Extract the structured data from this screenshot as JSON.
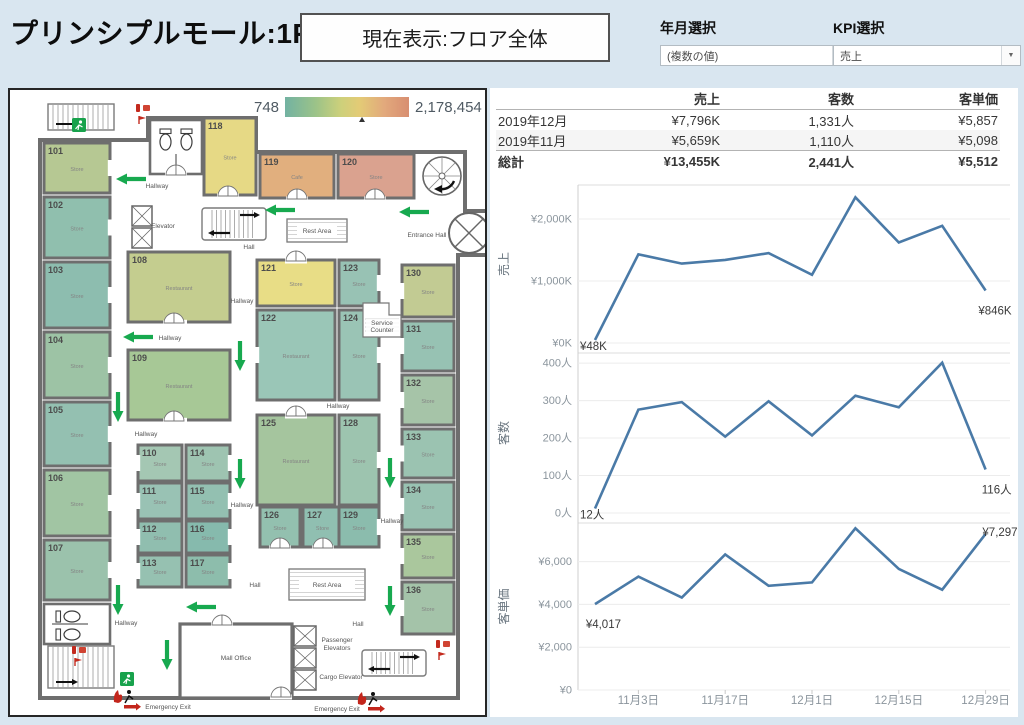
{
  "header": {
    "title": "プリンシプルモール:1F",
    "current_view": "現在表示:フロア全体",
    "filters": [
      {
        "label": "年月選択",
        "value": "(複数の値)"
      },
      {
        "label": "KPI選択",
        "value": "売上"
      }
    ],
    "caret_glyph": "▼"
  },
  "legend": {
    "min": "748",
    "max": "2,178,454",
    "marker_fraction": 0.6
  },
  "table": {
    "headers": [
      "",
      "売上",
      "客数",
      "客単価"
    ],
    "rows": [
      {
        "label": "2019年12月",
        "cells": [
          "¥7,796K",
          "1,331人",
          "¥5,857"
        ],
        "style": "normal"
      },
      {
        "label": "2019年11月",
        "cells": [
          "¥5,659K",
          "1,110人",
          "¥5,098"
        ],
        "style": "shaded"
      },
      {
        "label": "総計",
        "cells": [
          "¥13,455K",
          "2,441人",
          "¥5,512"
        ],
        "style": "total"
      }
    ]
  },
  "chart_data": {
    "type": "line",
    "line_color": "#4a7aa7",
    "x_axis": {
      "tick_labels": [
        "11月3日",
        "11月17日",
        "12月1日",
        "12月15日",
        "12月29日"
      ],
      "tick_point_indexes": [
        1,
        3,
        5,
        7,
        9
      ],
      "n_points": 10
    },
    "charts": [
      {
        "ylabel": "売上",
        "ymax": 2548,
        "unit": "K",
        "yticks": [
          {
            "v": 0,
            "label": "¥0K"
          },
          {
            "v": 1000,
            "label": "¥1,000K"
          },
          {
            "v": 2000,
            "label": "¥2,000K"
          }
        ],
        "values": [
          48,
          1430,
          1280,
          1340,
          1450,
          1100,
          2350,
          1620,
          1890,
          846
        ],
        "annotations": [
          {
            "text": "¥48K",
            "index": 0,
            "pos": "right"
          },
          {
            "text": "¥846K",
            "index": 9,
            "pos": "below"
          }
        ]
      },
      {
        "ylabel": "客数",
        "ymax": 427,
        "unit": "人",
        "yticks": [
          {
            "v": 0,
            "label": "0人"
          },
          {
            "v": 100,
            "label": "100人"
          },
          {
            "v": 200,
            "label": "200人"
          },
          {
            "v": 300,
            "label": "300人"
          },
          {
            "v": 400,
            "label": "400人"
          }
        ],
        "values": [
          12,
          276,
          296,
          204,
          298,
          207,
          313,
          282,
          401,
          116
        ],
        "annotations": [
          {
            "text": "12人",
            "index": 0,
            "pos": "right"
          },
          {
            "text": "116人",
            "index": 9,
            "pos": "below"
          }
        ]
      },
      {
        "ylabel": "客単価",
        "ymax": 7806,
        "unit": "円",
        "yticks": [
          {
            "v": 0,
            "label": "¥0"
          },
          {
            "v": 2000,
            "label": "¥2,000"
          },
          {
            "v": 4000,
            "label": "¥4,000"
          },
          {
            "v": 6000,
            "label": "¥6,000"
          }
        ],
        "values": [
          4017,
          5300,
          4320,
          6340,
          4870,
          5030,
          7560,
          5660,
          4690,
          7297
        ],
        "annotations": [
          {
            "text": "¥4,017",
            "index": 0,
            "pos": "below"
          },
          {
            "text": "¥7,297",
            "index": 9,
            "pos": "above"
          }
        ]
      }
    ]
  },
  "map": {
    "rooms": [
      {
        "id": "101",
        "label": "Store",
        "x": 34,
        "y": 53,
        "w": 66,
        "h": 50,
        "color": "#b6c893",
        "door": "right"
      },
      {
        "id": "102",
        "label": "Store",
        "x": 34,
        "y": 107,
        "w": 66,
        "h": 61,
        "color": "#90bfae",
        "door": "right"
      },
      {
        "id": "103",
        "label": "Store",
        "x": 34,
        "y": 172,
        "w": 66,
        "h": 66,
        "color": "#8dbdaf",
        "door": "right"
      },
      {
        "id": "104",
        "label": "Store",
        "x": 34,
        "y": 242,
        "w": 66,
        "h": 66,
        "color": "#9dc3a5",
        "door": "right"
      },
      {
        "id": "105",
        "label": "Store",
        "x": 34,
        "y": 312,
        "w": 66,
        "h": 64,
        "color": "#94c0b1",
        "door": "right"
      },
      {
        "id": "106",
        "label": "Store",
        "x": 34,
        "y": 380,
        "w": 66,
        "h": 66,
        "color": "#a1c5a3",
        "door": "right"
      },
      {
        "id": "107",
        "label": "Store",
        "x": 34,
        "y": 450,
        "w": 66,
        "h": 60,
        "color": "#9bc2ac",
        "door": "right"
      },
      {
        "id": "118",
        "label": "Store",
        "x": 194,
        "y": 28,
        "w": 52,
        "h": 77,
        "color": "#e6d985",
        "door": "bottom"
      },
      {
        "id": "119",
        "label": "Cafe",
        "x": 250,
        "y": 64,
        "w": 74,
        "h": 44,
        "color": "#e1af7e",
        "door": "bottom"
      },
      {
        "id": "120",
        "label": "Store",
        "x": 328,
        "y": 64,
        "w": 76,
        "h": 44,
        "color": "#daa28f",
        "door": "bottom"
      },
      {
        "id": "108",
        "label": "Restaurant",
        "x": 118,
        "y": 162,
        "w": 102,
        "h": 70,
        "color": "#c4cd8f",
        "door": "bottom"
      },
      {
        "id": "109",
        "label": "Restaurant",
        "x": 118,
        "y": 260,
        "w": 102,
        "h": 70,
        "color": "#a7c896",
        "door": "bottom"
      },
      {
        "id": "110",
        "label": "Store",
        "x": 128,
        "y": 355,
        "w": 44,
        "h": 36,
        "color": "#a4c7b3",
        "door": "left"
      },
      {
        "id": "114",
        "label": "Store",
        "x": 176,
        "y": 355,
        "w": 44,
        "h": 36,
        "color": "#9ec4b1",
        "door": "right"
      },
      {
        "id": "111",
        "label": "Store",
        "x": 128,
        "y": 393,
        "w": 44,
        "h": 36,
        "color": "#99c2b4",
        "door": "left"
      },
      {
        "id": "115",
        "label": "Store",
        "x": 176,
        "y": 393,
        "w": 44,
        "h": 36,
        "color": "#93c0b1",
        "door": "right"
      },
      {
        "id": "112",
        "label": "Store",
        "x": 128,
        "y": 431,
        "w": 44,
        "h": 32,
        "color": "#90beaf",
        "door": "left"
      },
      {
        "id": "116",
        "label": "Store",
        "x": 176,
        "y": 431,
        "w": 44,
        "h": 32,
        "color": "#86baad",
        "door": "right"
      },
      {
        "id": "113",
        "label": "Store",
        "x": 128,
        "y": 465,
        "w": 44,
        "h": 32,
        "color": "#96c1b1",
        "door": "left"
      },
      {
        "id": "117",
        "label": "Store",
        "x": 176,
        "y": 465,
        "w": 44,
        "h": 32,
        "color": "#8dbdac",
        "door": "right"
      },
      {
        "id": "121",
        "label": "Store",
        "x": 247,
        "y": 170,
        "w": 78,
        "h": 46,
        "color": "#e8dd86",
        "door": "top"
      },
      {
        "id": "123",
        "label": "Store",
        "x": 329,
        "y": 170,
        "w": 40,
        "h": 46,
        "color": "#98c2b4",
        "door": "right"
      },
      {
        "id": "122",
        "label": "Restaurant",
        "x": 247,
        "y": 220,
        "w": 78,
        "h": 90,
        "color": "#9ac6b7",
        "door": "left"
      },
      {
        "id": "124",
        "label": "Store",
        "x": 329,
        "y": 220,
        "w": 40,
        "h": 90,
        "color": "#9ac4b5",
        "door": "right"
      },
      {
        "id": "125",
        "label": "Restaurant",
        "x": 247,
        "y": 325,
        "w": 78,
        "h": 90,
        "color": "#a5c59e",
        "door": "top"
      },
      {
        "id": "128",
        "label": "Store",
        "x": 329,
        "y": 325,
        "w": 40,
        "h": 90,
        "color": "#9dc4af",
        "door": "right"
      },
      {
        "id": "126",
        "label": "Store",
        "x": 250,
        "y": 417,
        "w": 40,
        "h": 40,
        "color": "#93c0af",
        "door": "bottom"
      },
      {
        "id": "127",
        "label": "Store",
        "x": 293,
        "y": 417,
        "w": 39,
        "h": 40,
        "color": "#90bfb1",
        "door": "bottom"
      },
      {
        "id": "129",
        "label": "Store",
        "x": 329,
        "y": 417,
        "w": 40,
        "h": 40,
        "color": "#8bbcad",
        "door": "right"
      },
      {
        "id": "130",
        "label": "Store",
        "x": 392,
        "y": 175,
        "w": 52,
        "h": 52,
        "color": "#c2cb93",
        "door": "left"
      },
      {
        "id": "131",
        "label": "Store",
        "x": 392,
        "y": 231,
        "w": 52,
        "h": 50,
        "color": "#97c2b3",
        "door": "left"
      },
      {
        "id": "132",
        "label": "Store",
        "x": 392,
        "y": 285,
        "w": 52,
        "h": 50,
        "color": "#a6c4a8",
        "door": "left"
      },
      {
        "id": "133",
        "label": "Store",
        "x": 392,
        "y": 339,
        "w": 52,
        "h": 49,
        "color": "#9bc3b1",
        "door": "left"
      },
      {
        "id": "134",
        "label": "Store",
        "x": 392,
        "y": 392,
        "w": 52,
        "h": 48,
        "color": "#99c2b2",
        "door": "left"
      },
      {
        "id": "135",
        "label": "Store",
        "x": 392,
        "y": 444,
        "w": 52,
        "h": 44,
        "color": "#aac79d",
        "door": "left"
      },
      {
        "id": "136",
        "label": "Store",
        "x": 392,
        "y": 492,
        "w": 52,
        "h": 52,
        "color": "#a4c3a9",
        "door": "left"
      }
    ],
    "labels": [
      {
        "text": "Hallway",
        "x": 147,
        "y": 98
      },
      {
        "text": "Hallway",
        "x": 232,
        "y": 213
      },
      {
        "text": "Hallway",
        "x": 160,
        "y": 250
      },
      {
        "text": "Hallway",
        "x": 136,
        "y": 346
      },
      {
        "text": "Hallway",
        "x": 232,
        "y": 417
      },
      {
        "text": "Hallway",
        "x": 328,
        "y": 318
      },
      {
        "text": "Hallway",
        "x": 382,
        "y": 433
      },
      {
        "text": "Hallway",
        "x": 116,
        "y": 535
      },
      {
        "text": "Hall",
        "x": 239,
        "y": 159
      },
      {
        "text": "Hall",
        "x": 245,
        "y": 497
      },
      {
        "text": "Hall",
        "x": 348,
        "y": 536
      },
      {
        "text": "Elevator",
        "x": 153,
        "y": 138
      },
      {
        "text": "Entrance Hall",
        "x": 417,
        "y": 147
      },
      {
        "text": "Mall Office",
        "x": 226,
        "y": 570
      },
      {
        "text": "Passenger",
        "x": 327,
        "y": 552
      },
      {
        "text": "Elevators",
        "x": 327,
        "y": 560
      },
      {
        "text": "Cargo Elevator",
        "x": 331,
        "y": 589
      },
      {
        "text": "Emergency Exit",
        "x": 158,
        "y": 619
      },
      {
        "text": "Emergency Exit",
        "x": 327,
        "y": 621
      }
    ],
    "arrows": [
      {
        "x": 121,
        "y": 89,
        "dir": "left"
      },
      {
        "x": 270,
        "y": 120,
        "dir": "left"
      },
      {
        "x": 404,
        "y": 122,
        "dir": "left"
      },
      {
        "x": 128,
        "y": 247,
        "dir": "left"
      },
      {
        "x": 230,
        "y": 266,
        "dir": "down"
      },
      {
        "x": 108,
        "y": 317,
        "dir": "down"
      },
      {
        "x": 230,
        "y": 384,
        "dir": "down"
      },
      {
        "x": 380,
        "y": 383,
        "dir": "down"
      },
      {
        "x": 108,
        "y": 510,
        "dir": "down"
      },
      {
        "x": 191,
        "y": 517,
        "dir": "left"
      },
      {
        "x": 157,
        "y": 565,
        "dir": "down"
      },
      {
        "x": 380,
        "y": 511,
        "dir": "down"
      }
    ],
    "fixtures": [
      {
        "type": "stairs",
        "x": 38,
        "y": 14,
        "w": 66,
        "h": 26
      },
      {
        "type": "wc",
        "x": 140,
        "y": 30,
        "w": 52,
        "h": 54,
        "orient": "v"
      },
      {
        "type": "elevator",
        "x": 122,
        "y": 116,
        "w": 20,
        "h": 42,
        "cells": 2
      },
      {
        "type": "escalator",
        "x": 192,
        "y": 118,
        "w": 64,
        "h": 32
      },
      {
        "type": "rest",
        "x": 277,
        "y": 129,
        "w": 60,
        "h": 23,
        "label": "Rest Area"
      },
      {
        "type": "counter",
        "x": 353,
        "y": 213,
        "label": "Service",
        "label2": "Counter"
      },
      {
        "type": "spiral",
        "cx": 432,
        "cy": 86,
        "r": 19
      },
      {
        "type": "rotunda",
        "cx": 459,
        "cy": 143,
        "r": 20
      },
      {
        "type": "wc",
        "x": 34,
        "y": 514,
        "w": 66,
        "h": 40,
        "orient": "h"
      },
      {
        "type": "stairs",
        "x": 38,
        "y": 556,
        "w": 66,
        "h": 42
      },
      {
        "type": "office",
        "x": 170,
        "y": 534,
        "w": 112,
        "h": 74
      },
      {
        "type": "elevator",
        "x": 284,
        "y": 536,
        "w": 22,
        "h": 64,
        "cells": 3
      },
      {
        "type": "escalator",
        "x": 352,
        "y": 560,
        "w": 64,
        "h": 26
      },
      {
        "type": "rest",
        "x": 279,
        "y": 479,
        "w": 76,
        "h": 31,
        "label": "Rest Area"
      },
      {
        "type": "exitsign",
        "x": 62,
        "y": 28
      },
      {
        "type": "exitsign",
        "x": 110,
        "y": 582
      },
      {
        "type": "redkit",
        "x": 126,
        "y": 14
      },
      {
        "type": "redkit",
        "x": 62,
        "y": 556
      },
      {
        "type": "redkit",
        "x": 426,
        "y": 550
      },
      {
        "type": "exitmark",
        "x": 104,
        "y": 600
      },
      {
        "type": "exitmark",
        "x": 348,
        "y": 602
      },
      {
        "type": "door2",
        "x": 218,
        "y": 106
      },
      {
        "type": "door2",
        "x": 287,
        "y": 109
      },
      {
        "type": "door2",
        "x": 365,
        "y": 109
      },
      {
        "type": "door2",
        "x": 166,
        "y": 85
      },
      {
        "type": "door2",
        "x": 286,
        "y": 171
      },
      {
        "type": "door2",
        "x": 164,
        "y": 233
      },
      {
        "type": "door2",
        "x": 164,
        "y": 331
      },
      {
        "type": "door2",
        "x": 286,
        "y": 326
      },
      {
        "type": "door2",
        "x": 270,
        "y": 458
      },
      {
        "type": "door2",
        "x": 313,
        "y": 458
      },
      {
        "type": "door2",
        "x": 212,
        "y": 535
      },
      {
        "type": "door2",
        "x": 271,
        "y": 607
      }
    ]
  }
}
